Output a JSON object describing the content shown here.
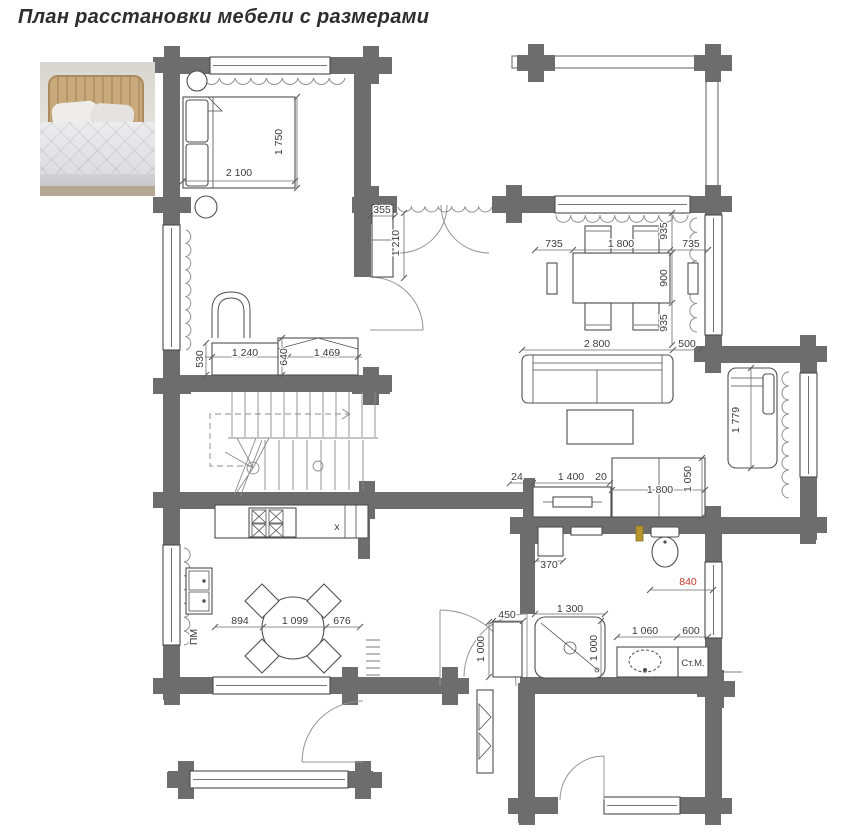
{
  "title": "План расстановки мебели с размерами",
  "colors": {
    "wall": "#6d6d6d",
    "furniture_line": "#4f4f4f",
    "dim_text": "#3b3b3b",
    "dim_accent": "#c0392b",
    "radiator": "#8f8f8f"
  },
  "bedroom": {
    "bed_width": "2 100",
    "bed_depth": "1 750",
    "desk_depth": "530",
    "desk_width": "1 240",
    "dresser_depth": "640",
    "dresser_width": "1 469"
  },
  "hall": {
    "cabinet_width": "355",
    "cabinet_depth": "1 210"
  },
  "dining": {
    "gap_left": "735",
    "table_length": "1 800",
    "gap_right": "735",
    "gap_top": "935",
    "table_width": "900",
    "gap_bottom": "935"
  },
  "living": {
    "sofa_length": "2 800",
    "sofa_gap": "500",
    "tv_gap_left": "24",
    "tv_stand_width": "1 400",
    "tv_gap_right": "20",
    "sideboard_length": "1 800",
    "sideboard_depth": "1 050",
    "daybed_length": "1 779"
  },
  "kitchen": {
    "gap_left": "894",
    "table_diameter": "1 099",
    "gap_right": "676",
    "dishwasher_label": "ПМ",
    "fridge_mark": "x"
  },
  "bathroom": {
    "cabinet_width": "370",
    "toilet_offset": "840",
    "cab_width": "450",
    "cab_depth": "1 000",
    "shower_width": "1 300",
    "shower_depth": "1 000",
    "vanity_width": "1 060",
    "washer_width": "600",
    "washer_label": "Ст.М."
  }
}
